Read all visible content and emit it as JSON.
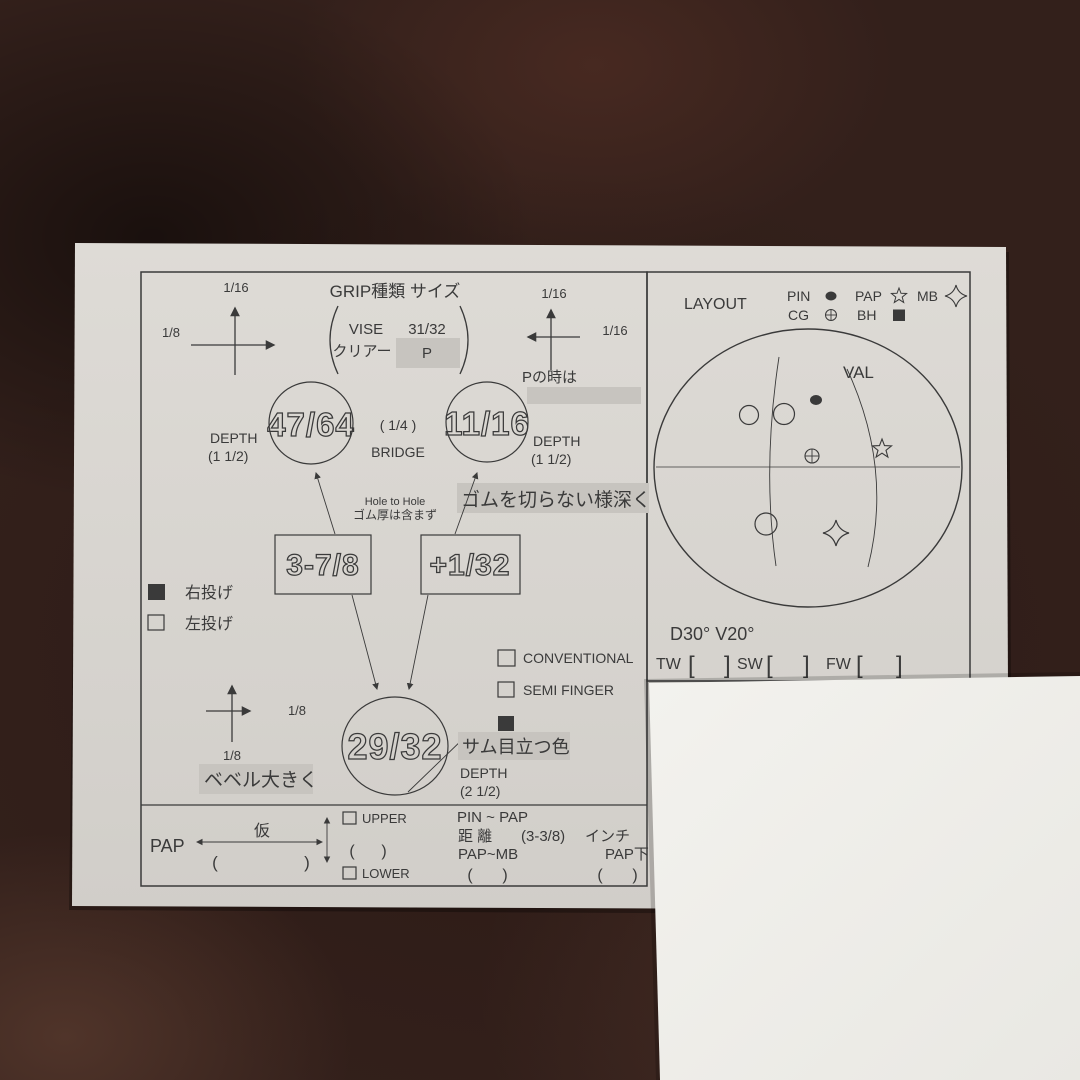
{
  "colors": {
    "fabric": "#33201b",
    "paper": "#d8d5d0",
    "paper_bright": "#f1f0ec",
    "ink": "#3a3a3a",
    "highlight": "#c7c4bf"
  },
  "grip_header": {
    "title": "GRIP種類 サイズ",
    "brand": "VISE",
    "size": "31/32",
    "clear_label": "クリアー",
    "clear_value": "P",
    "p_note": "Pの時は"
  },
  "adjust_arrows": {
    "top_left_up": "1/16",
    "top_left_side": "1/8",
    "top_right_up": "1/16",
    "top_right_side": "1/16",
    "bottom_left_side": "1/8",
    "bottom_left_down": "1/8"
  },
  "holes": {
    "finger_left": "47/64",
    "finger_right": "11/16",
    "thumb": "29/32",
    "depth_label": "DEPTH",
    "depth_fingers": "(1  1/2)",
    "depth_thumb": "(2  1/2)",
    "bridge_value": "( 1/4 )",
    "bridge_label": "BRIDGE",
    "span_left": "3-7/8",
    "span_right": "+1/32",
    "hole_to_hole_1": "Hole to Hole",
    "hole_to_hole_2": "ゴム厚は含まず"
  },
  "notes": {
    "rubber": "ゴムを切らない様深く",
    "bevel": "ベベル大きく",
    "thumb_color": "サム目立つ色"
  },
  "hand_options": {
    "right": "右投げ",
    "left": "左投げ"
  },
  "grip_styles": {
    "conventional": "CONVENTIONAL",
    "semi_finger": "SEMI  FINGER"
  },
  "layout_panel": {
    "title": "LAYOUT",
    "legend": {
      "pin": "PIN",
      "pap": "PAP",
      "mb": "MB",
      "cg": "CG",
      "bh": "BH"
    },
    "val": "VAL",
    "angles": "D30°  V20°",
    "tw": "TW",
    "sw": "SW",
    "fw": "FW",
    "bracket_open": "[",
    "bracket_close": "]"
  },
  "pap_section": {
    "pap": "PAP",
    "temp": "仮",
    "paren_open": "(",
    "paren_close": ")",
    "upper": "UPPER",
    "lower": "LOWER",
    "pin_to_pap": "PIN ~ PAP",
    "distance_label": "距 離",
    "distance_value": "(3-3/8)",
    "unit": "インチ",
    "pap_mb": "PAP~MB",
    "pap_below": "PAP下"
  }
}
